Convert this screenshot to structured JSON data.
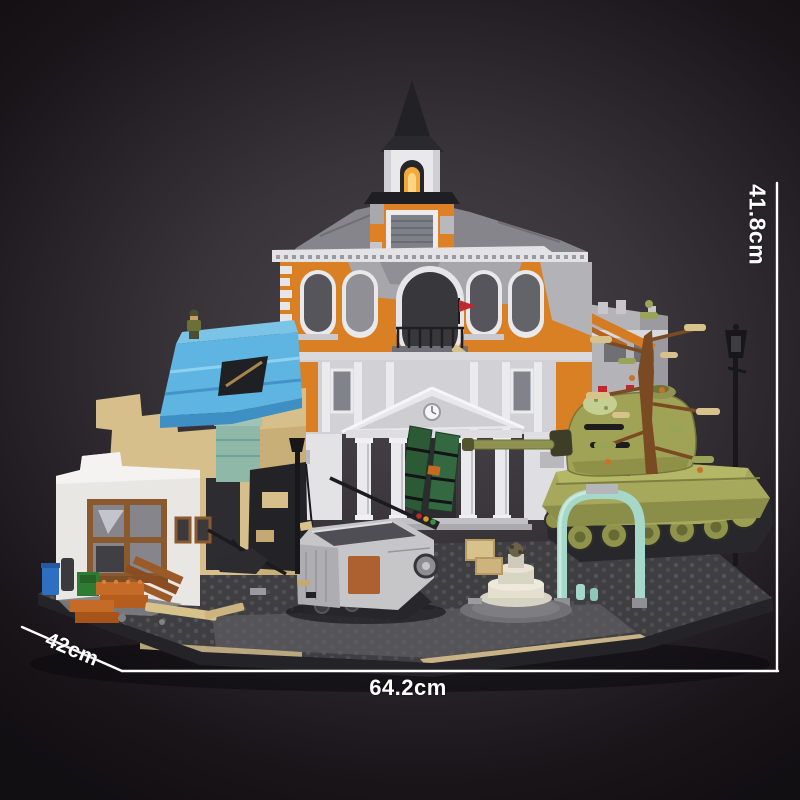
{
  "image": {
    "alt": "Brick-built diorama photo: war-damaged town hall with clock tower, ruined blue-roofed house, olive tank with dead tree, grey half-track and street debris on a dark spotlight backdrop with printed product dimensions"
  },
  "dimensions": {
    "height_label": "41.8cm",
    "width_label": "64.2cm",
    "depth_label": "42cm"
  },
  "palette": {
    "background_center": "#4a464c",
    "background_edge": "#120f13",
    "dimension_line": "#ffffff",
    "facade_orange": "#d97f24",
    "trim_white": "#e9e9ec",
    "roof_blue": "#5fb5e1",
    "wall_tan": "#d6bf8a",
    "tank_olive": "#a6a95c",
    "arch_mint": "#a5d8c9",
    "window_glow": "#f2a93b",
    "flag_red": "#c1272d",
    "door_green": "#2c5a36",
    "base_gray": "#3f3e41"
  }
}
